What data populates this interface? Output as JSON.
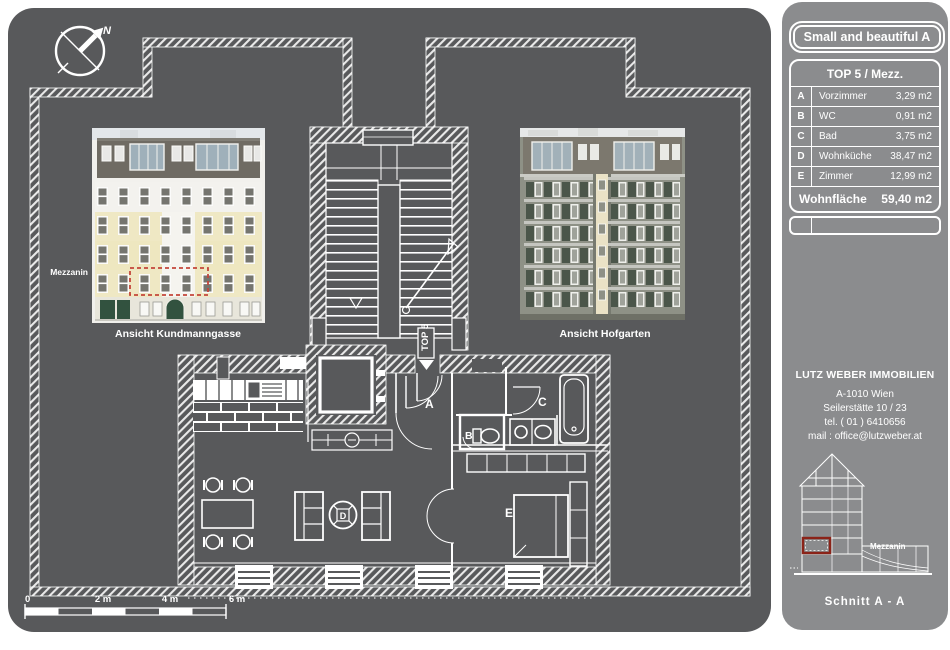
{
  "colors": {
    "panel": "#58595b",
    "sidebar": "#8b8c8e",
    "line": "#ffffff",
    "plan_red": "#c4453a",
    "section_red": "#8b2318",
    "facade_yellow": "#efe8c4",
    "facade_green": "#4b564a"
  },
  "compass": {
    "north": "N"
  },
  "facades": {
    "left": {
      "floor_label": "Mezzanin",
      "caption": "Ansicht Kundmanngasse"
    },
    "right": {
      "caption": "Ansicht Hofgarten"
    }
  },
  "plan": {
    "unit": "TOP 5",
    "rooms": {
      "a": "A",
      "b": "B",
      "c": "C",
      "d": "D",
      "e": "E"
    }
  },
  "scalebar": {
    "t0": "0",
    "t2": "2 m",
    "t4": "4 m",
    "t6": "6 m"
  },
  "sidebar": {
    "title": "Small and beautiful A",
    "table": {
      "header": "TOP 5 / Mezz.",
      "rows": [
        {
          "letter": "A",
          "name": "Vorzimmer",
          "area": "3,29 m2"
        },
        {
          "letter": "B",
          "name": "WC",
          "area": "0,91 m2"
        },
        {
          "letter": "C",
          "name": "Bad",
          "area": "3,75 m2"
        },
        {
          "letter": "D",
          "name": "Wohnküche",
          "area": "38,47 m2"
        },
        {
          "letter": "E",
          "name": "Zimmer",
          "area": "12,99 m2"
        }
      ],
      "total_label": "Wohnfläche",
      "total_value": "59,40 m2"
    },
    "contact": {
      "company": "LUTZ WEBER IMMOBILIEN",
      "line1": "A-1010 Wien",
      "line2": "Seilerstätte 10 / 23",
      "line3": "tel. ( 01 ) 6410656",
      "line4": "mail : office@lutzweber.at"
    },
    "section": {
      "floor_label": "Mezzanin",
      "caption": "Schnitt A - A"
    }
  }
}
